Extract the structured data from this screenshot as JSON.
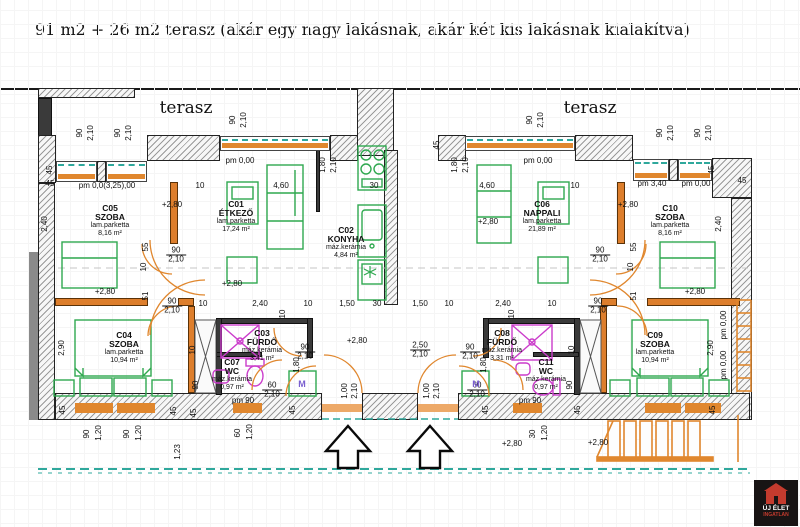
{
  "title": "91 m2 + 26 m2 terasz (akár egy nagy lakásnak, akár két kis lakásnak kialakítva)",
  "logo": {
    "name": "ÚJ ÉLET",
    "tagline": "INGATLAN"
  },
  "colors": {
    "wall_orange": "#dd7e2c",
    "furniture_green": "#2fa84f",
    "fixture_magenta": "#cb3ccb",
    "window_teal": "#2fa89c",
    "logo_red": "#c43b2e"
  },
  "plan": {
    "terraces": [
      {
        "label": "terasz",
        "x": 186,
        "y": 108
      },
      {
        "label": "terasz",
        "x": 590,
        "y": 108
      }
    ],
    "rooms": [
      {
        "id": "C05",
        "name": "SZOBA",
        "finish": "lam.parketta",
        "area": "8,16 m²",
        "x": 110,
        "y": 204
      },
      {
        "id": "C01",
        "name": "ÉTKEZŐ",
        "finish": "lam.parketta",
        "area": "17,24 m²",
        "x": 236,
        "y": 200
      },
      {
        "id": "C02",
        "name": "KONYHA",
        "finish": "máz.kerámia",
        "area": "4,84 m²",
        "x": 346,
        "y": 226
      },
      {
        "id": "C06",
        "name": "NAPPALI",
        "finish": "lam.parketta",
        "area": "21,89 m²",
        "x": 542,
        "y": 200
      },
      {
        "id": "C10",
        "name": "SZOBA",
        "finish": "lam.parketta",
        "area": "8,16 m²",
        "x": 670,
        "y": 204
      },
      {
        "id": "C04",
        "name": "SZOBA",
        "finish": "lam.parketta",
        "area": "10,94 m²",
        "x": 124,
        "y": 331
      },
      {
        "id": "C03",
        "name": "FÜRDŐ",
        "finish": "máz.kerámia",
        "area": "3,41 m²",
        "x": 262,
        "y": 329
      },
      {
        "id": "C07",
        "name": "WC",
        "finish": "máz.kerámia",
        "area": "0,97 m²",
        "x": 232,
        "y": 358
      },
      {
        "id": "C08",
        "name": "FÜRDŐ",
        "finish": "máz.kerámia",
        "area": "3,31 m²",
        "x": 502,
        "y": 329
      },
      {
        "id": "C11",
        "name": "WC",
        "finish": "máz.kerámia",
        "area": "0,97 m²",
        "x": 546,
        "y": 358
      },
      {
        "id": "C09",
        "name": "SZOBA",
        "finish": "lam.parketta",
        "area": "10,94 m²",
        "x": 655,
        "y": 331
      }
    ],
    "annotations": [
      {
        "t": "pm 0,00",
        "x": 240,
        "y": 161
      },
      {
        "t": "pm 0,00",
        "x": 538,
        "y": 161
      },
      {
        "t": "pm 0,0(3,25),00",
        "x": 107,
        "y": 186
      },
      {
        "t": "45",
        "x": 50,
        "y": 184
      },
      {
        "t": "10",
        "x": 200,
        "y": 186
      },
      {
        "t": "4,60",
        "x": 281,
        "y": 186
      },
      {
        "t": "30",
        "x": 374,
        "y": 186
      },
      {
        "t": "4,60",
        "x": 487,
        "y": 186
      },
      {
        "t": "10",
        "x": 575,
        "y": 186
      },
      {
        "t": "pm 3,40",
        "x": 652,
        "y": 184
      },
      {
        "t": "pm 0,00",
        "x": 696,
        "y": 184
      },
      {
        "t": "45",
        "x": 742,
        "y": 181
      },
      {
        "t": "+2,80",
        "x": 172,
        "y": 205
      },
      {
        "t": "+2,80",
        "x": 628,
        "y": 205
      },
      {
        "t": "+2,80",
        "x": 232,
        "y": 284
      },
      {
        "t": "+2,80",
        "x": 488,
        "y": 222
      },
      {
        "t": "+2,80",
        "x": 105,
        "y": 292
      },
      {
        "t": "+2,80",
        "x": 695,
        "y": 292
      },
      {
        "t": "+2,80",
        "x": 357,
        "y": 341
      },
      {
        "t": "+2,80",
        "x": 512,
        "y": 444
      },
      {
        "t": "+2,80",
        "x": 598,
        "y": 443
      },
      {
        "t": "10",
        "x": 203,
        "y": 304
      },
      {
        "t": "2,40",
        "x": 260,
        "y": 304
      },
      {
        "t": "10",
        "x": 308,
        "y": 304
      },
      {
        "t": "1,50",
        "x": 347,
        "y": 304
      },
      {
        "t": "30",
        "x": 377,
        "y": 304
      },
      {
        "t": "1,50",
        "x": 420,
        "y": 304
      },
      {
        "t": "10",
        "x": 449,
        "y": 304
      },
      {
        "t": "2,40",
        "x": 503,
        "y": 304
      },
      {
        "t": "10",
        "x": 552,
        "y": 304
      },
      {
        "t": "pm 90",
        "x": 243,
        "y": 401
      },
      {
        "t": "pm 90",
        "x": 530,
        "y": 401
      },
      {
        "t": "90",
        "b": "2,10",
        "x": 172,
        "y": 306
      },
      {
        "t": "90",
        "b": "2,10",
        "x": 598,
        "y": 306
      },
      {
        "t": "90",
        "b": "2,10",
        "x": 176,
        "y": 255
      },
      {
        "t": "90",
        "b": "2,10",
        "x": 600,
        "y": 255
      },
      {
        "t": "90",
        "b": "2,10",
        "x": 305,
        "y": 352
      },
      {
        "t": "90",
        "b": "2,10",
        "x": 470,
        "y": 352
      },
      {
        "t": "60",
        "b": "2,10",
        "x": 272,
        "y": 390
      },
      {
        "t": "60",
        "b": "2,10",
        "x": 477,
        "y": 390
      },
      {
        "t": "2,50",
        "b": "2,10",
        "x": 420,
        "y": 350
      },
      {
        "t": "M",
        "x": 302,
        "y": 384,
        "m": 1
      },
      {
        "t": "M",
        "x": 476,
        "y": 384,
        "m": 1
      },
      {
        "t": "90",
        "x": 80,
        "y": 133,
        "rot": 1
      },
      {
        "t": "2,10",
        "x": 91,
        "y": 133,
        "rot": 1
      },
      {
        "t": "90",
        "x": 118,
        "y": 133,
        "rot": 1
      },
      {
        "t": "2,10",
        "x": 129,
        "y": 133,
        "rot": 1
      },
      {
        "t": "90",
        "x": 233,
        "y": 120,
        "rot": 1
      },
      {
        "t": "2,10",
        "x": 244,
        "y": 120,
        "rot": 1
      },
      {
        "t": "1,80",
        "x": 323,
        "y": 165,
        "rot": 1
      },
      {
        "t": "2,10",
        "x": 334,
        "y": 165,
        "rot": 1
      },
      {
        "t": "45",
        "x": 437,
        "y": 145,
        "rot": 1
      },
      {
        "t": "1,80",
        "x": 455,
        "y": 165,
        "rot": 1
      },
      {
        "t": "2,10",
        "x": 466,
        "y": 165,
        "rot": 1
      },
      {
        "t": "90",
        "x": 530,
        "y": 120,
        "rot": 1
      },
      {
        "t": "2,10",
        "x": 541,
        "y": 120,
        "rot": 1
      },
      {
        "t": "90",
        "x": 660,
        "y": 133,
        "rot": 1
      },
      {
        "t": "2,10",
        "x": 671,
        "y": 133,
        "rot": 1
      },
      {
        "t": "90",
        "x": 698,
        "y": 133,
        "rot": 1
      },
      {
        "t": "2,10",
        "x": 709,
        "y": 133,
        "rot": 1
      },
      {
        "t": "45",
        "x": 50,
        "y": 170,
        "rot": 1
      },
      {
        "t": "2,40",
        "x": 45,
        "y": 224,
        "rot": 1
      },
      {
        "t": "45",
        "x": 712,
        "y": 170,
        "rot": 1
      },
      {
        "t": "2,40",
        "x": 719,
        "y": 224,
        "rot": 1
      },
      {
        "t": "55",
        "x": 146,
        "y": 247,
        "rot": 1
      },
      {
        "t": "10",
        "x": 144,
        "y": 267,
        "rot": 1
      },
      {
        "t": "51",
        "x": 146,
        "y": 296,
        "rot": 1
      },
      {
        "t": "55",
        "x": 634,
        "y": 247,
        "rot": 1
      },
      {
        "t": "10",
        "x": 631,
        "y": 267,
        "rot": 1
      },
      {
        "t": "51",
        "x": 634,
        "y": 296,
        "rot": 1
      },
      {
        "t": "2,90",
        "x": 62,
        "y": 348,
        "rot": 1
      },
      {
        "t": "2,90",
        "x": 711,
        "y": 348,
        "rot": 1
      },
      {
        "t": "1,80",
        "x": 297,
        "y": 365,
        "rot": 1
      },
      {
        "t": "1,80",
        "x": 484,
        "y": 365,
        "rot": 1
      },
      {
        "t": "10",
        "x": 193,
        "y": 350,
        "rot": 1
      },
      {
        "t": "90",
        "x": 196,
        "y": 385,
        "rot": 1
      },
      {
        "t": "10",
        "x": 572,
        "y": 350,
        "rot": 1
      },
      {
        "t": "90",
        "x": 570,
        "y": 385,
        "rot": 1
      },
      {
        "t": "10",
        "x": 283,
        "y": 314,
        "rot": 1
      },
      {
        "t": "10",
        "x": 512,
        "y": 314,
        "rot": 1
      },
      {
        "t": "1,00",
        "x": 345,
        "y": 391,
        "rot": 1
      },
      {
        "t": "2,10",
        "x": 355,
        "y": 391,
        "rot": 1
      },
      {
        "t": "1,00",
        "x": 427,
        "y": 391,
        "rot": 1
      },
      {
        "t": "2,10",
        "x": 437,
        "y": 391,
        "rot": 1
      },
      {
        "t": "45",
        "x": 63,
        "y": 410,
        "rot": 1
      },
      {
        "t": "90",
        "x": 87,
        "y": 434,
        "rot": 1
      },
      {
        "t": "1,20",
        "x": 99,
        "y": 433,
        "rot": 1
      },
      {
        "t": "90",
        "x": 127,
        "y": 434,
        "rot": 1
      },
      {
        "t": "1,20",
        "x": 139,
        "y": 433,
        "rot": 1
      },
      {
        "t": "45",
        "x": 174,
        "y": 411,
        "rot": 1
      },
      {
        "t": "45",
        "x": 194,
        "y": 413,
        "rot": 1
      },
      {
        "t": "1,23",
        "x": 178,
        "y": 452,
        "rot": 1
      },
      {
        "t": "60",
        "x": 238,
        "y": 433,
        "rot": 1
      },
      {
        "t": "1,20",
        "x": 250,
        "y": 432,
        "rot": 1
      },
      {
        "t": "45",
        "x": 293,
        "y": 410,
        "rot": 1
      },
      {
        "t": "45",
        "x": 486,
        "y": 410,
        "rot": 1
      },
      {
        "t": "30",
        "x": 533,
        "y": 434,
        "rot": 1
      },
      {
        "t": "1,20",
        "x": 545,
        "y": 433,
        "rot": 1
      },
      {
        "t": "45",
        "x": 578,
        "y": 410,
        "rot": 1
      },
      {
        "t": "45",
        "x": 713,
        "y": 410,
        "rot": 1
      },
      {
        "t": "pm 0,00",
        "x": 724,
        "y": 325,
        "rot": 1
      },
      {
        "t": "pm 0,00",
        "x": 724,
        "y": 365,
        "rot": 1
      }
    ]
  }
}
